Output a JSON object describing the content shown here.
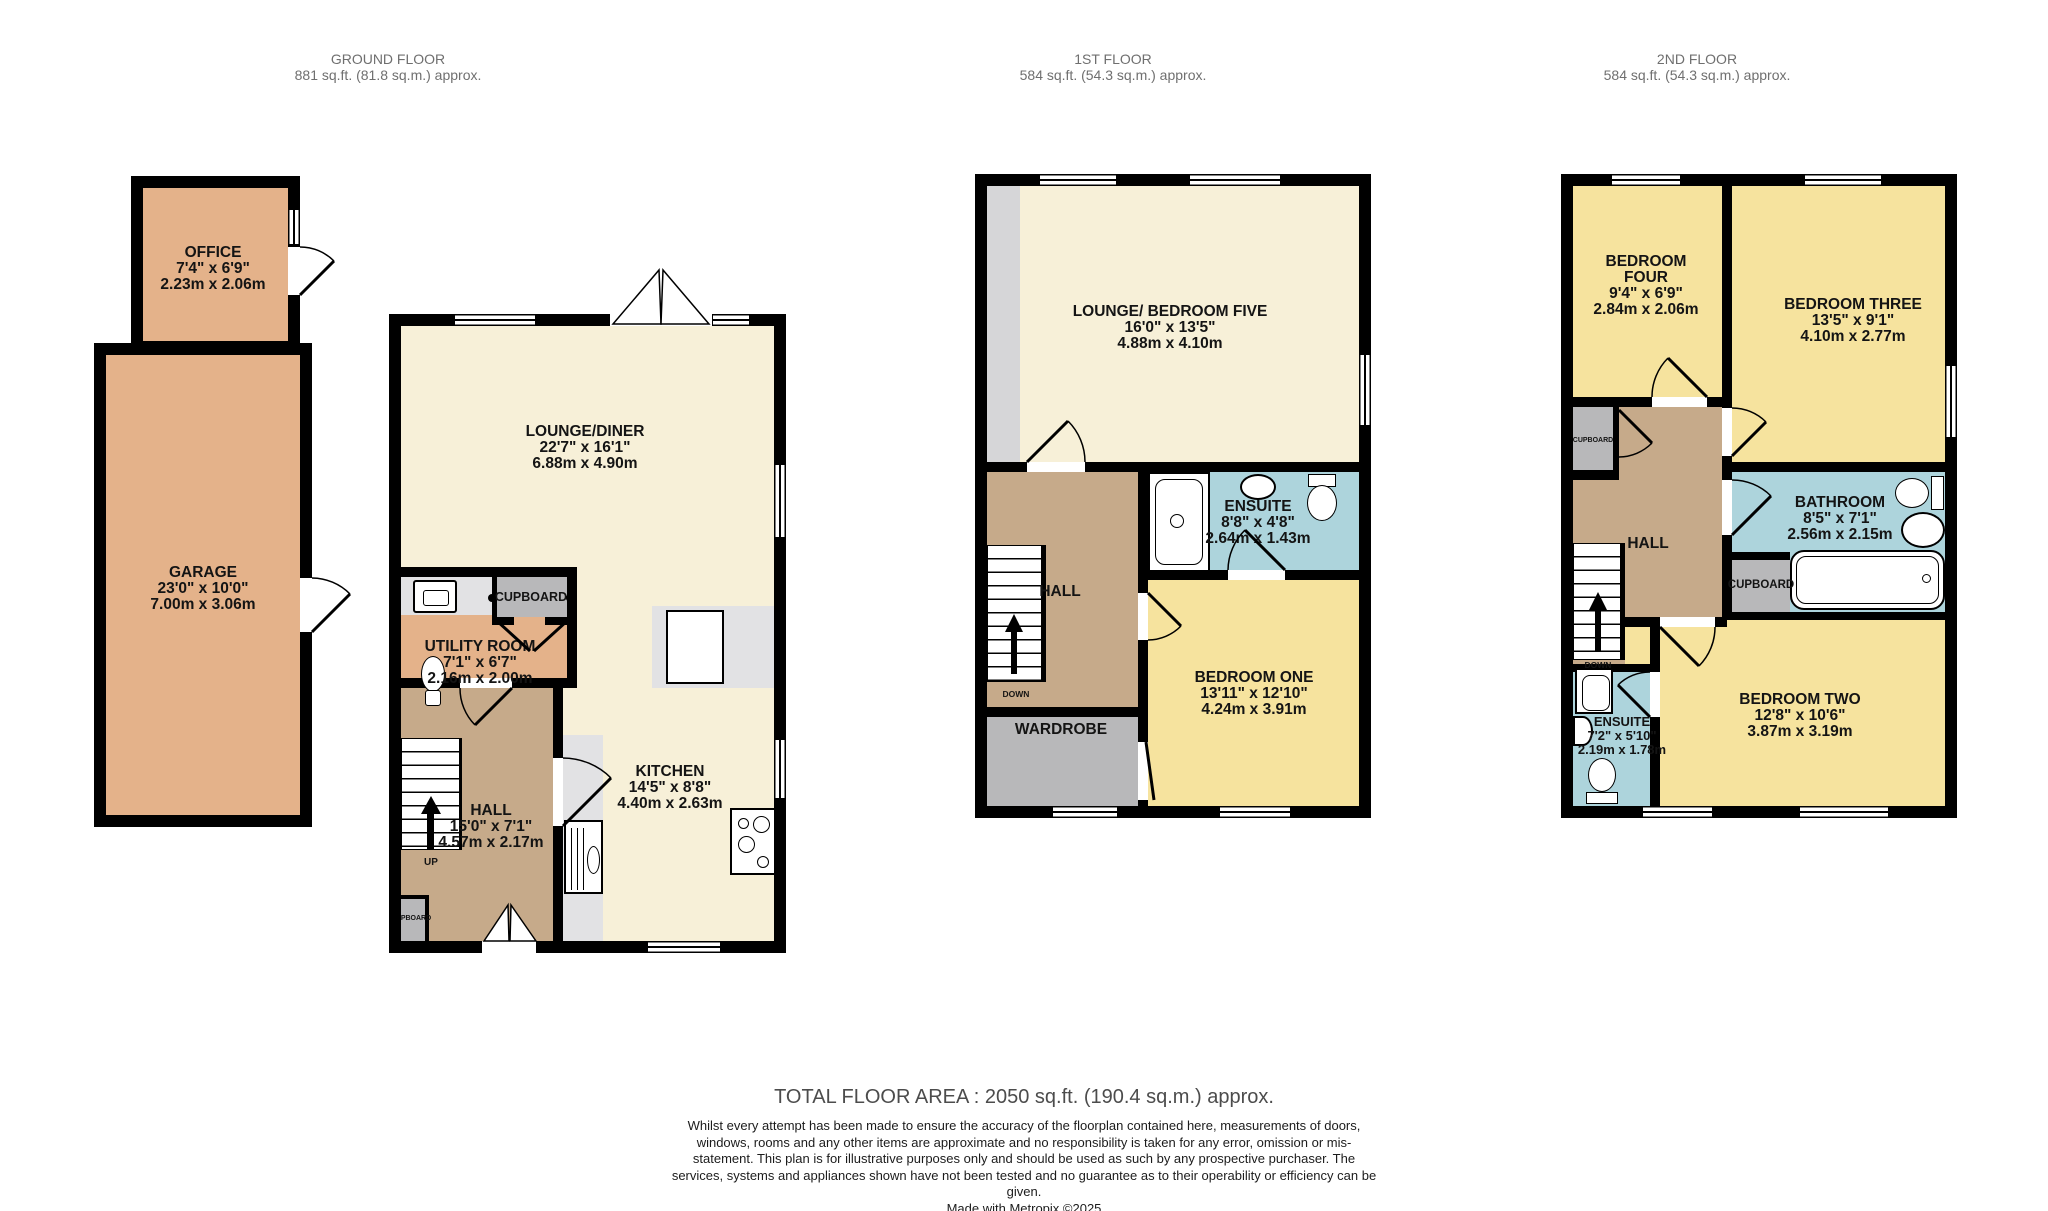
{
  "headers": {
    "ground": {
      "title": "GROUND FLOOR",
      "area": "881 sq.ft. (81.8 sq.m.) approx."
    },
    "first": {
      "title": "1ST FLOOR",
      "area": "584 sq.ft. (54.3 sq.m.) approx."
    },
    "second": {
      "title": "2ND FLOOR",
      "area": "584 sq.ft. (54.3 sq.m.) approx."
    }
  },
  "rooms": {
    "office": {
      "name": "OFFICE",
      "ft": "7'4\" x 6'9\"",
      "m": "2.23m x 2.06m"
    },
    "garage": {
      "name": "GARAGE",
      "ft": "23'0\" x 10'0\"",
      "m": "7.00m x 3.06m"
    },
    "lounge_diner": {
      "name": "LOUNGE/DINER",
      "ft": "22'7\" x 16'1\"",
      "m": "6.88m x 4.90m"
    },
    "utility": {
      "name": "UTILITY ROOM",
      "ft": "7'1\" x 6'7\"",
      "m": "2.16m x 2.00m"
    },
    "cupboard_gf": {
      "name": "CUPBOARD"
    },
    "kitchen": {
      "name": "KITCHEN",
      "ft": "14'5\" x 8'8\"",
      "m": "4.40m x 2.63m"
    },
    "hall_gf": {
      "name": "HALL",
      "ft": "15'0\" x 7'1\"",
      "m": "4.57m x 2.17m"
    },
    "pboard_gf": {
      "name": "PBOARD"
    },
    "up": {
      "name": "UP"
    },
    "lounge_bed5": {
      "name": "LOUNGE/ BEDROOM FIVE",
      "ft": "16'0\" x 13'5\"",
      "m": "4.88m x 4.10m"
    },
    "ensuite_1f": {
      "name": "ENSUITE",
      "ft": "8'8\" x 4'8\"",
      "m": "2.64m x 1.43m"
    },
    "hall_1f": {
      "name": "HALL"
    },
    "down": {
      "name": "DOWN"
    },
    "wardrobe": {
      "name": "WARDROBE"
    },
    "bedroom_one": {
      "name": "BEDROOM ONE",
      "ft": "13'11\" x 12'10\"",
      "m": "4.24m x 3.91m"
    },
    "bedroom_four": {
      "name": "BEDROOM",
      "name2": "FOUR",
      "ft": "9'4\" x 6'9\"",
      "m": "2.84m x 2.06m"
    },
    "bedroom_three": {
      "name": "BEDROOM THREE",
      "ft": "13'5\" x 9'1\"",
      "m": "4.10m x 2.77m"
    },
    "cupboard_2f_left": {
      "name": "CUPBOARD"
    },
    "hall_2f": {
      "name": "HALL"
    },
    "bathroom": {
      "name": "BATHROOM",
      "ft": "8'5\" x 7'1\"",
      "m": "2.56m x 2.15m"
    },
    "cupboard_2f_mid": {
      "name": "CUPBOARD"
    },
    "ensuite_2f": {
      "name": "ENSUITE",
      "ft": "7'2\" x 5'10\"",
      "m": "2.19m x 1.78m"
    },
    "bedroom_two": {
      "name": "BEDROOM TWO",
      "ft": "12'8\" x 10'6\"",
      "m": "3.87m x 3.19m"
    }
  },
  "footer": {
    "total": "TOTAL FLOOR AREA : 2050 sq.ft. (190.4 sq.m.) approx.",
    "disclaimer": "Whilst every attempt has been made to ensure the accuracy of the floorplan contained here, measurements of doors, windows, rooms and any other items are approximate and no responsibility is taken for any error, omission or mis-statement. This plan is for illustrative purposes only and should be used as such by any prospective purchaser. The services, systems and appliances shown have not been tested and no guarantee as to their operability or efficiency can be given.",
    "credit": "Made with Metropix ©2025"
  },
  "colors": {
    "room_orange": "#e4b28a",
    "room_cream": "#f7f0d8",
    "room_yellow": "#f6e39e",
    "room_blue": "#add4dc",
    "hall_brown": "#c6aa8a",
    "cupboard_gray": "#b8b8ba",
    "counter_gray": "#e2e2e4",
    "landing_gray": "#d6d6d8",
    "wall": "#000000",
    "header_text": "#6f6f6f"
  }
}
